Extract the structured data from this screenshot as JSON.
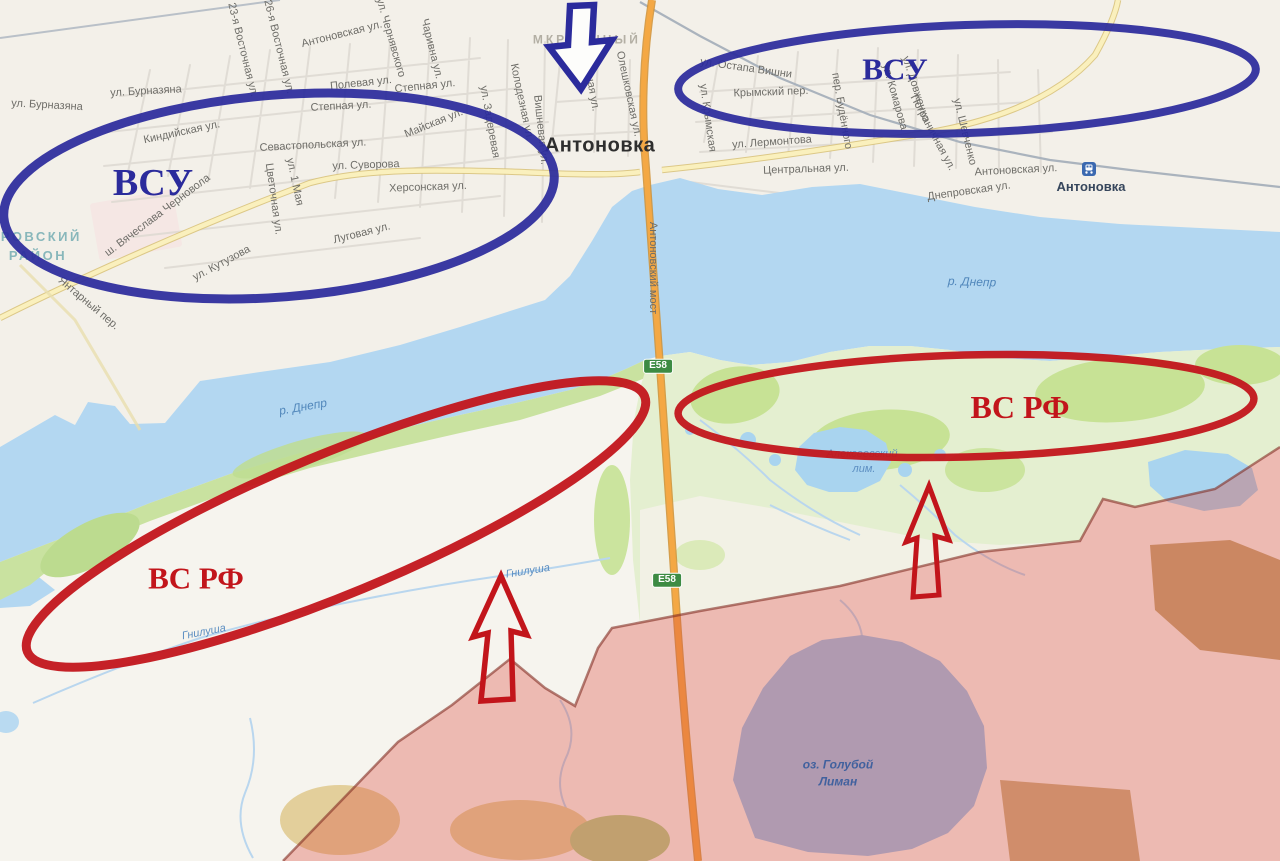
{
  "colors": {
    "annotation_blue": "#2b2b9c",
    "annotation_red": "#c2151b",
    "water": "#b3d7f1",
    "land": "#f6f4ee",
    "city": "#f3f0e9",
    "green_shore": "#c9e2a0",
    "green_island": "#e4efd0",
    "occupied_overlay": "rgba(220,70,58,0.33)",
    "occupied_border": "rgba(130,45,35,0.6)",
    "highway_orange": "#f4a844",
    "road_yellow": "#faf0bd"
  },
  "annotations": {
    "west_blue": "ВСУ",
    "east_blue": "ВСУ",
    "west_red": "ВС РФ",
    "east_red": "ВС РФ"
  },
  "map_labels": [
    {
      "n": "street-burnazyana-w",
      "t": "ул. Бурназяна",
      "x": 47,
      "y": 106,
      "r": 3,
      "c": "street"
    },
    {
      "n": "street-burnazyana-e",
      "t": "ул. Бурназяна",
      "x": 146,
      "y": 92,
      "r": -3,
      "c": "street"
    },
    {
      "n": "street-kindiyskaya",
      "t": "Киндийская ул.",
      "x": 182,
      "y": 133,
      "r": -12,
      "c": "street"
    },
    {
      "n": "street-sevastopolskaya",
      "t": "Севастопольская ул.",
      "x": 313,
      "y": 146,
      "r": -3,
      "c": "street"
    },
    {
      "n": "street-suvorova",
      "t": "ул. Суворова",
      "x": 366,
      "y": 166,
      "r": -2,
      "c": "street"
    },
    {
      "n": "street-1maya",
      "t": "ул. 1 Мая",
      "x": 294,
      "y": 182,
      "r": 78,
      "c": "street"
    },
    {
      "n": "street-tsvetochnaya",
      "t": "Цветочная ул.",
      "x": 273,
      "y": 199,
      "r": 82,
      "c": "street"
    },
    {
      "n": "street-chernovola",
      "t": "ш. Вячеслава Черновола",
      "x": 158,
      "y": 216,
      "r": -37,
      "c": "street"
    },
    {
      "n": "street-kutuzova",
      "t": "ул. Кутузова",
      "x": 222,
      "y": 264,
      "r": -28,
      "c": "street"
    },
    {
      "n": "street-lugovaya",
      "t": "Луговая ул.",
      "x": 362,
      "y": 234,
      "r": -14,
      "c": "street"
    },
    {
      "n": "street-yantarny",
      "t": "Янтарный пер.",
      "x": 88,
      "y": 304,
      "r": 40,
      "c": "street"
    },
    {
      "n": "street-khersonskaya",
      "t": "Херсонская ул.",
      "x": 428,
      "y": 188,
      "r": -2,
      "c": "street"
    },
    {
      "n": "street-23-vostochnaya",
      "t": "23-я Восточная ул.",
      "x": 242,
      "y": 50,
      "r": 76,
      "c": "street"
    },
    {
      "n": "street-26-vostochnaya",
      "t": "26-я Восточная ул.",
      "x": 278,
      "y": 47,
      "r": 76,
      "c": "street"
    },
    {
      "n": "street-antonovskaya-w",
      "t": "Антоновская ул.",
      "x": 342,
      "y": 35,
      "r": -14,
      "c": "street"
    },
    {
      "n": "street-chernyavskogo",
      "t": "ул. Чернявского",
      "x": 390,
      "y": 38,
      "r": 74,
      "c": "street"
    },
    {
      "n": "street-charivna",
      "t": "Чаривна ул.",
      "x": 431,
      "y": 49,
      "r": 76,
      "c": "street"
    },
    {
      "n": "street-polevaya",
      "t": "Полевая ул.",
      "x": 361,
      "y": 84,
      "r": -6,
      "c": "street"
    },
    {
      "n": "street-stepnaya-1",
      "t": "Степная ул.",
      "x": 425,
      "y": 87,
      "r": -6,
      "c": "street"
    },
    {
      "n": "street-stepnaya-2",
      "t": "Степная ул.",
      "x": 341,
      "y": 107,
      "r": -3,
      "c": "street"
    },
    {
      "n": "street-mayskaya",
      "t": "Майская ул.",
      "x": 434,
      "y": 124,
      "r": -22,
      "c": "street"
    },
    {
      "n": "street-zaderevaya",
      "t": "ул. Задеревая",
      "x": 489,
      "y": 122,
      "r": 80,
      "c": "street"
    },
    {
      "n": "street-kolodeznaya",
      "t": "Колодезная ул.",
      "x": 521,
      "y": 102,
      "r": 78,
      "c": "street"
    },
    {
      "n": "street-vishnevaya",
      "t": "Вишневая ул.",
      "x": 540,
      "y": 130,
      "r": 84,
      "c": "street"
    },
    {
      "n": "street-mirnaya",
      "t": "Мирная ул.",
      "x": 590,
      "y": 83,
      "r": 80,
      "c": "street"
    },
    {
      "n": "street-oleshkovskaya",
      "t": "Олешковская ул.",
      "x": 628,
      "y": 94,
      "r": 78,
      "c": "street"
    },
    {
      "n": "street-ostapa-vishni",
      "t": "ул. Остапа Вишни",
      "x": 746,
      "y": 69,
      "r": 8,
      "c": "street"
    },
    {
      "n": "street-krymsky-per",
      "t": "Крымский пер.",
      "x": 771,
      "y": 93,
      "r": -2,
      "c": "street"
    },
    {
      "n": "street-krymskaya",
      "t": "ул. Крымская",
      "x": 707,
      "y": 118,
      "r": 82,
      "c": "street"
    },
    {
      "n": "street-budennogo",
      "t": "пер. Будённого",
      "x": 841,
      "y": 111,
      "r": 80,
      "c": "street"
    },
    {
      "n": "street-komarova",
      "t": "ул. Комарова",
      "x": 894,
      "y": 97,
      "r": 74,
      "c": "street"
    },
    {
      "n": "street-dovzhenko",
      "t": "ул. Довженко",
      "x": 915,
      "y": 89,
      "r": 72,
      "c": "street"
    },
    {
      "n": "street-pogranichnaya",
      "t": "Пограничная ул.",
      "x": 932,
      "y": 133,
      "r": 62,
      "c": "street"
    },
    {
      "n": "street-shevchenko",
      "t": "ул. Шевченко",
      "x": 964,
      "y": 132,
      "r": 76,
      "c": "street"
    },
    {
      "n": "street-lermontova",
      "t": "ул. Лермонтова",
      "x": 772,
      "y": 143,
      "r": -4,
      "c": "street"
    },
    {
      "n": "street-tsentralnaya",
      "t": "Центральная ул.",
      "x": 806,
      "y": 170,
      "r": -2,
      "c": "street"
    },
    {
      "n": "street-antonovskaya-e",
      "t": "Антоновская ул.",
      "x": 1016,
      "y": 171,
      "r": -3,
      "c": "street"
    },
    {
      "n": "street-dneprovskaya",
      "t": "Днепровская ул.",
      "x": 969,
      "y": 192,
      "r": -8,
      "c": "street"
    },
    {
      "n": "town-antonovka",
      "t": "Антоновка",
      "x": 600,
      "y": 146,
      "r": 0,
      "c": "town"
    },
    {
      "n": "station-antonovka-label",
      "t": "Антоновка",
      "x": 1091,
      "y": 187,
      "r": 0,
      "c": "town-sm"
    },
    {
      "n": "district-name-line1",
      "t": "ДНЕПРОВСКИЙ",
      "x": 18,
      "y": 237,
      "r": 0,
      "c": "district"
    },
    {
      "n": "district-name-line2",
      "t": "РАЙОН",
      "x": 38,
      "y": 256,
      "r": 0,
      "c": "district"
    },
    {
      "n": "river-dnepr-w",
      "t": "р. Днепр",
      "x": 303,
      "y": 407,
      "r": -10,
      "c": "water"
    },
    {
      "n": "river-dnepr-e",
      "t": "р. Днепр",
      "x": 972,
      "y": 282,
      "r": 2,
      "c": "water"
    },
    {
      "n": "liman-alekseevsky-line1",
      "t": "Алексеевский",
      "x": 862,
      "y": 455,
      "r": 0,
      "c": "water-sm"
    },
    {
      "n": "liman-alekseevsky-line2",
      "t": "лим.",
      "x": 864,
      "y": 470,
      "r": 0,
      "c": "water-sm"
    },
    {
      "n": "river-gnilusha-e",
      "t": "Гнилуша",
      "x": 528,
      "y": 572,
      "r": -9,
      "c": "water-sm"
    },
    {
      "n": "river-gnilusha-w",
      "t": "Гнилуша",
      "x": 204,
      "y": 633,
      "r": -11,
      "c": "water-sm"
    },
    {
      "n": "lake-goluboy-liman-line1",
      "t": "оз. Голубой",
      "x": 838,
      "y": 765,
      "r": 0,
      "c": "lake"
    },
    {
      "n": "lake-goluboy-liman-line2",
      "t": "Лиман",
      "x": 838,
      "y": 782,
      "r": 0,
      "c": "lake"
    },
    {
      "n": "microdistrict-part1",
      "t": "МКР",
      "x": 550,
      "y": 40,
      "r": 0,
      "c": "area"
    },
    {
      "n": "microdistrict-part2",
      "t": "ННЫЙ",
      "x": 616,
      "y": 40,
      "r": 0,
      "c": "area"
    },
    {
      "n": "road-shield-e58-north",
      "t": "E58",
      "x": 658,
      "y": 366,
      "r": 0,
      "c": "shield"
    },
    {
      "n": "road-shield-e58-south",
      "t": "E58",
      "x": 667,
      "y": 580,
      "r": 0,
      "c": "shield"
    },
    {
      "n": "annotation-vsu-west",
      "t": "ВСУ",
      "x": 153,
      "y": 184,
      "r": 0,
      "c": "ann-blue",
      "s": 38
    },
    {
      "n": "annotation-vsu-east",
      "t": "ВСУ",
      "x": 895,
      "y": 70,
      "r": 0,
      "c": "ann-blue",
      "s": 31
    },
    {
      "n": "annotation-vsrf-west",
      "t": "ВС РФ",
      "x": 196,
      "y": 579,
      "r": 0,
      "c": "ann-red",
      "s": 31
    },
    {
      "n": "annotation-vsrf-east",
      "t": "ВС РФ",
      "x": 1020,
      "y": 408,
      "r": 0,
      "c": "ann-red",
      "s": 32
    }
  ],
  "bridge_label": {
    "n": "bridge-antonovsky",
    "t": "Антоновский мост",
    "x": 652,
    "y": 268,
    "r": 90,
    "c": "street"
  }
}
